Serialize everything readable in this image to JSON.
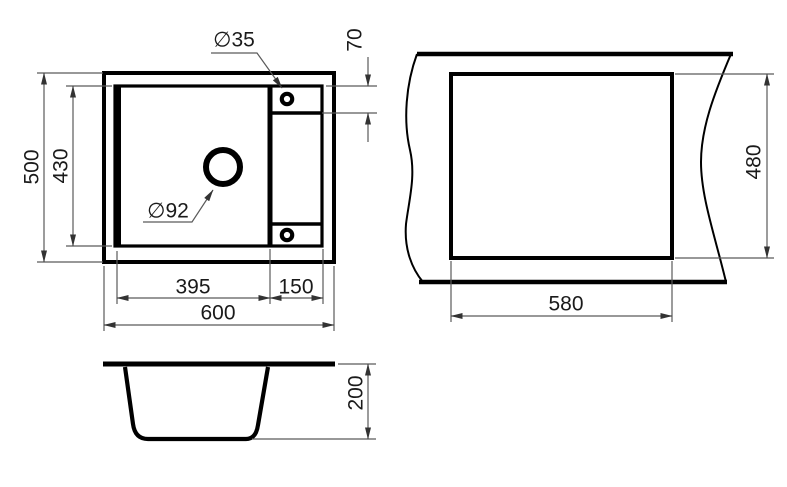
{
  "colors": {
    "background": "#ffffff",
    "geometry_line": "#000000",
    "dimension_line": "#5a5a5a",
    "text": "#1a1a1a"
  },
  "views": {
    "plan": {
      "labels": {
        "overall_width": "600",
        "overall_depth": "500",
        "bowl_inner_width": "395",
        "bowl_inner_depth": "430",
        "wing_width": "150",
        "tap_hole_offset": "70",
        "tap_hole_diameter": "∅35",
        "drain_diameter": "∅92"
      }
    },
    "cutout": {
      "labels": {
        "cutout_width": "580",
        "cutout_depth": "480"
      }
    },
    "section": {
      "labels": {
        "bowl_height": "200"
      }
    }
  }
}
